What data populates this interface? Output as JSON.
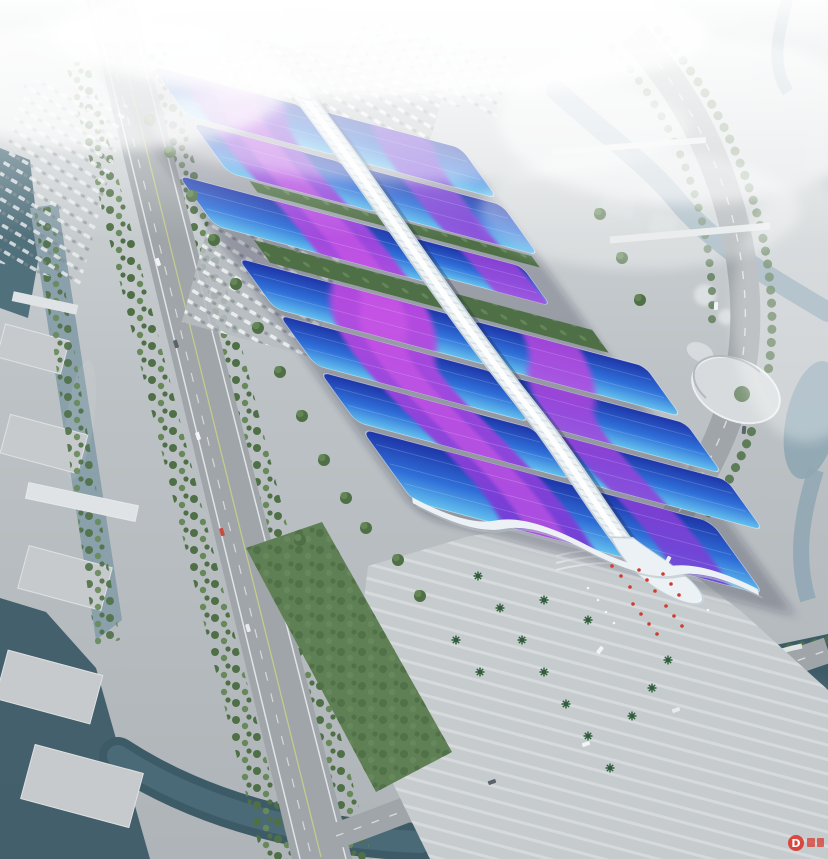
{
  "scene": {
    "watermark": {
      "letter": "D"
    }
  },
  "colors": {
    "haze": "#ffffff",
    "ground_top": "#d8dcde",
    "ground_mid": "#bcc2c5",
    "ground_bottom": "#aeb4b7",
    "roof_deep": "#1e35a8",
    "roof_mid": "#2f6fd8",
    "roof_light": "#63c0ee",
    "ribbon_purple": "#6d3ad4",
    "ribbon_magenta": "#bb4ae0",
    "ribbon_core": "#d45ae8",
    "spine": "#ebf1f4",
    "spine_edge": "#c7d3da",
    "river_left": "#8aa0aa",
    "river_city": "#8fa7b4",
    "water_dark": "#3d5b67",
    "pond_dark": "#50707c",
    "road": "#9fa5a8",
    "road_line": "#e8ebec",
    "median_line": "#c9cf8a",
    "tree_dark": "#4f7046",
    "tree_light": "#67895a",
    "palm": "#2f5d3a",
    "lawn": "#5f7f55",
    "plaza": "#c6cbcd",
    "plaza_stripe": "#d8dcde",
    "flag_red": "#cf3b30",
    "building": "#ced4d7",
    "bridge": "#dfe3e5",
    "watermark_red": "#d93025"
  }
}
